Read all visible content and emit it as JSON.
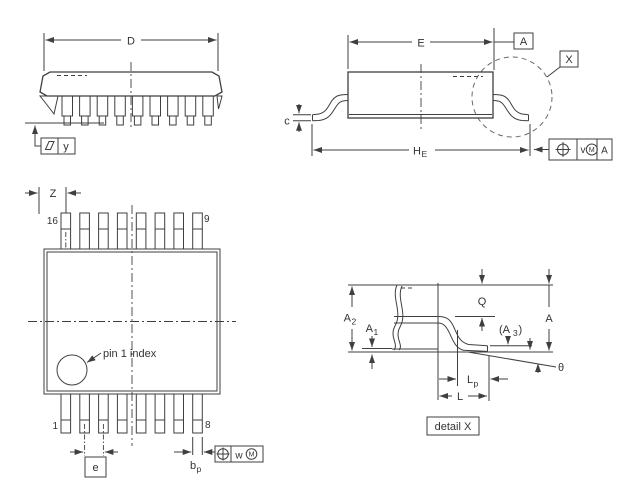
{
  "title": "IC package outline drawing",
  "colors": {
    "line": "#3f3f3f",
    "text": "#333333",
    "background": "#ffffff"
  },
  "views": {
    "perspective": {
      "dim_d": "D",
      "flatness_frame": {
        "symbol": "flatness-parallelogram",
        "value": "y"
      }
    },
    "side": {
      "dim_e": "E",
      "datum": "A",
      "detail_marker": "X",
      "dim_c": "c",
      "dim_he": {
        "base": "H",
        "sub": "E"
      },
      "tolerance_frame": {
        "symbol": "position",
        "value": "v",
        "modifier": "M",
        "datum": "A"
      }
    },
    "top": {
      "dim_z": "Z",
      "pin_labels": {
        "top_left": "16",
        "top_right": "9",
        "bottom_left": "1",
        "bottom_right": "8"
      },
      "pin1_note": "pin 1 index",
      "dim_e": "e",
      "dim_bp": {
        "base": "b",
        "sub": "p"
      },
      "tolerance_frame": {
        "symbol": "position",
        "value": "w",
        "modifier": "M"
      }
    },
    "detail": {
      "dim_a": "A",
      "dim_a1": {
        "base": "A",
        "sub": "1"
      },
      "dim_a2": {
        "base": "A",
        "sub": "2"
      },
      "dim_a3": {
        "open": "(A",
        "sub": "3",
        "close": ")"
      },
      "dim_q": "Q",
      "dim_l": "L",
      "dim_lp": {
        "base": "L",
        "sub": "p"
      },
      "dim_theta": "θ",
      "caption": "detail X"
    }
  }
}
